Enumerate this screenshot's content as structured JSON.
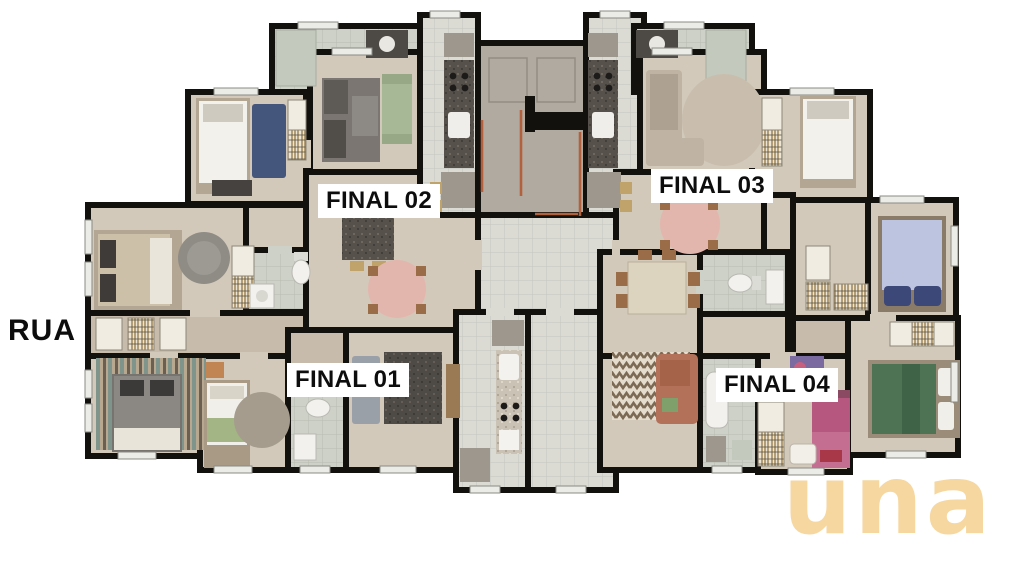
{
  "street_label": "RUA",
  "units": [
    {
      "id": "final-01",
      "label": "FINAL 01"
    },
    {
      "id": "final-02",
      "label": "FINAL 02"
    },
    {
      "id": "final-03",
      "label": "FINAL 03"
    },
    {
      "id": "final-04",
      "label": "FINAL 04"
    }
  ],
  "logo": {
    "text": "una",
    "color": "#f6d7a0"
  },
  "colors": {
    "page_bg": "#ffffff",
    "wall": "#13110e",
    "floor": "#d3c9ba",
    "floor_dark": "#c7bcac",
    "tile": "#cdd1c7",
    "tile_light": "#dbdbd4",
    "core": "#b1aaa1",
    "copper": "#b2613c",
    "label_bg": "#ffffff",
    "label_text": "#0d0d0d"
  }
}
